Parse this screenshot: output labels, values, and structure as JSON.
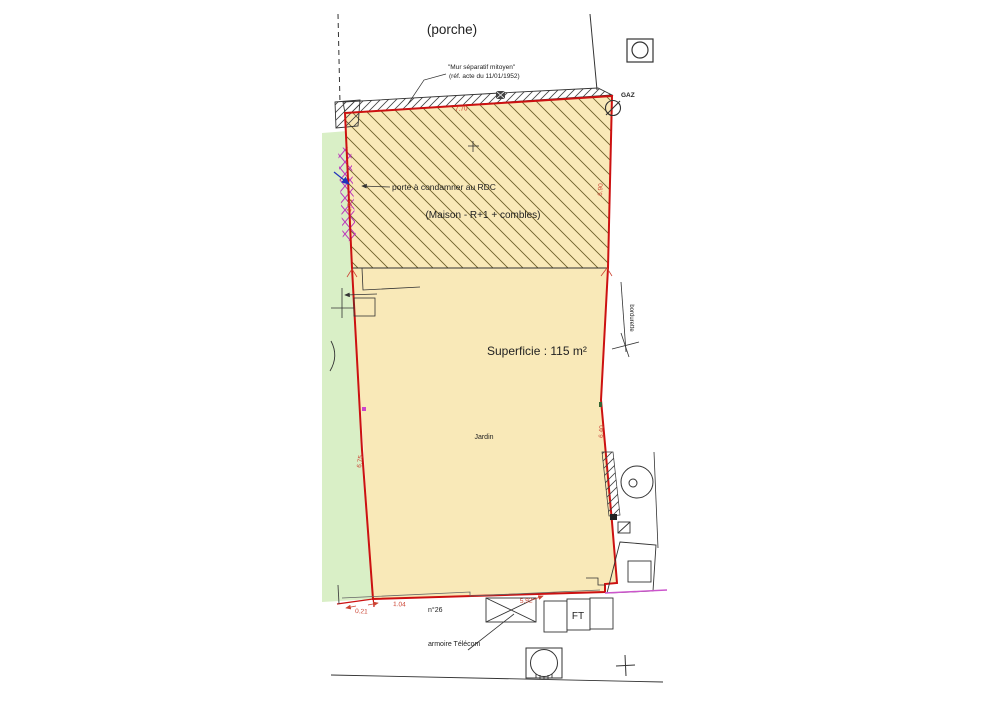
{
  "plan": {
    "area_labels": {
      "porche": "(porche)",
      "maison": "(Maison - R+1 + combles)",
      "superficie": "Superficie : 115 m²",
      "jardin": "Jardin"
    },
    "annotations": {
      "mur_note1": "\"Mur séparatif mitoyen\"",
      "mur_note2": "(réf. acte du 11/01/1952)",
      "porte": "porte à condamner au RDC",
      "armoire": "armoire Télécom",
      "bordurette": "bordurette",
      "gaz": "GAZ",
      "numero": "n°26",
      "ft": "FT"
    },
    "dimensions_m": {
      "top": "7.70",
      "maison_left": "1.95",
      "maison_right": "6.90",
      "jardin_left": "6.75",
      "jardin_right": "6.40",
      "bottom_a": "0.21",
      "bottom_b": "1.04",
      "bottom_c": "5.92"
    },
    "colors": {
      "boundary_red": "#cc1111",
      "dimension_red": "#cc4433",
      "parcel_yellow": "#f9e9b8",
      "garden_green": "#d9efc6",
      "separative_magenta": "#bb33bb",
      "arrow_blue": "#2233bb",
      "line_black": "#333333"
    }
  }
}
